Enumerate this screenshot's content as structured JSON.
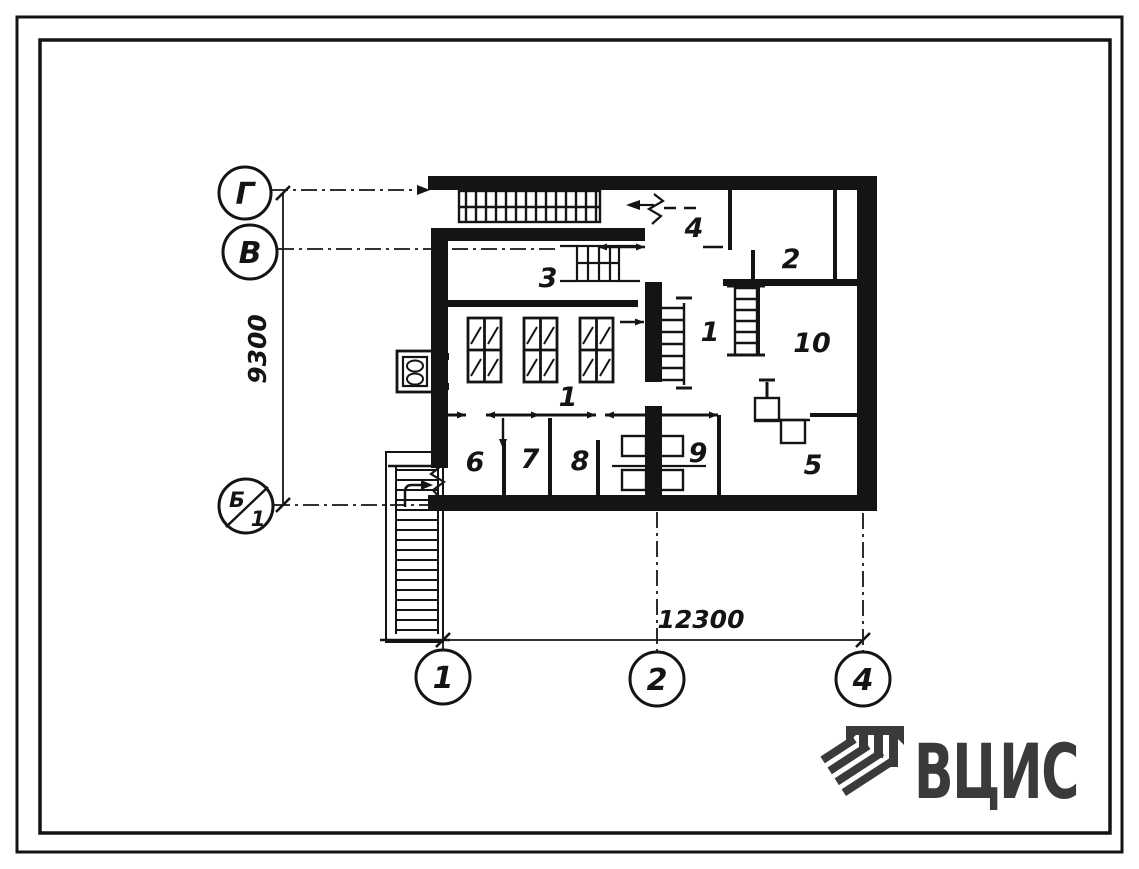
{
  "axes": {
    "left": [
      {
        "label": "Г"
      },
      {
        "label": "В"
      }
    ],
    "left_split": {
      "top": "Б",
      "bottom": "1"
    },
    "bottom": [
      {
        "label": "1"
      },
      {
        "label": "2"
      },
      {
        "label": "4"
      }
    ]
  },
  "dimensions": {
    "vertical": "9300",
    "horizontal": "12300"
  },
  "rooms": {
    "hall": "1",
    "corridor": "1",
    "r2": "2",
    "r3": "3",
    "r4": "4",
    "r5": "5",
    "r6": "6",
    "r7": "7",
    "r8": "8",
    "r9": "9",
    "r10": "10"
  },
  "logo": {
    "text": "ВЦИС"
  },
  "colors": {
    "ink": "#141414",
    "logo": "#3a3a3c",
    "paper": "#ffffff"
  }
}
